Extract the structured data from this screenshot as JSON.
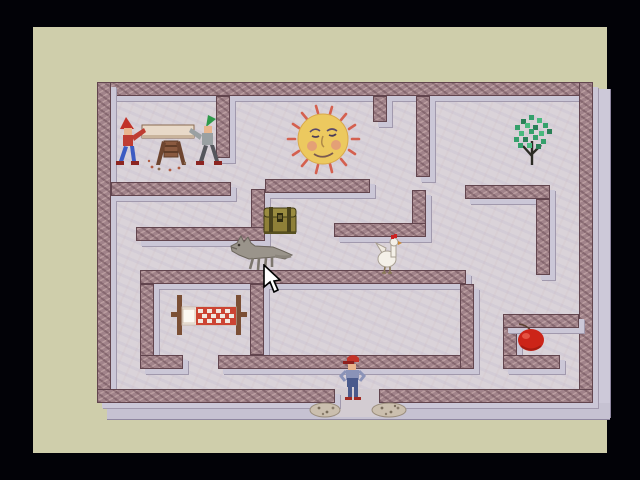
{
  "game": {
    "scene": "isometric stone maze on tan game screen with black surround",
    "entrance": "gap in bottom wall at center with rubble piles on both sides"
  },
  "colors": {
    "surround": "#020207",
    "screen": "#cfceab",
    "floor": "#dad3d9",
    "wall_top": "#a1838a",
    "wall_edge": "#62454e",
    "wall_side": "#cbc7d7",
    "sun_body": "#ecc95f",
    "sun_rays": "#d4604f",
    "tree_leaf": "#35a06b",
    "apple": "#cc2418",
    "bed_blanket": "#cc4433",
    "gnome_cap_left": "#c13228",
    "gnome_cap_right": "#2f9a4a",
    "boy_overalls": "#4a5a8c"
  },
  "maze": {
    "floor_rect": "left:64px;top:55px;width:496px;height:321px;background-color:#dad3d9;background-image:repeating-linear-gradient(23deg, rgba(170,160,195,.14) 0 3px, rgba(0,0,0,0) 3px 9px),repeating-linear-gradient(-67deg, rgba(200,170,170,.10) 0 2px, rgba(0,0,0,0) 2px 11px);",
    "ext_right": "left:560px;top:62px;width:17px;height:328px;background:#cdc9d9;border-right:1px solid #8f87a0;border-bottom:1px solid #8f87a0;",
    "ext_bottom": "left:74px;top:376px;width:503px;height:16px;background:#c6c2d2;border-bottom:1px solid #8f87a0;",
    "entrance_rect": "left:302px;top:362px;width:44px;height:28px;background:#d3ccd2;",
    "walls": [
      {
        "name": "outer-top",
        "x": 64,
        "y": 55,
        "w": 496,
        "h": 14
      },
      {
        "name": "outer-left",
        "x": 64,
        "y": 55,
        "w": 14,
        "h": 321
      },
      {
        "name": "outer-right",
        "x": 546,
        "y": 55,
        "w": 14,
        "h": 321
      },
      {
        "name": "outer-bottom-left",
        "x": 64,
        "y": 362,
        "w": 238,
        "h": 14
      },
      {
        "name": "outer-bottom-right",
        "x": 346,
        "y": 362,
        "w": 214,
        "h": 14
      },
      {
        "name": "gnome-room-right",
        "x": 183,
        "y": 69,
        "w": 14,
        "h": 62
      },
      {
        "name": "gnome-room-bottom",
        "x": 78,
        "y": 155,
        "w": 120,
        "h": 14
      },
      {
        "name": "chest-left-vertical",
        "x": 218,
        "y": 162,
        "w": 14,
        "h": 52
      },
      {
        "name": "mid-left-horizontal",
        "x": 103,
        "y": 200,
        "w": 129,
        "h": 14
      },
      {
        "name": "sun-room-bottom",
        "x": 232,
        "y": 152,
        "w": 105,
        "h": 14
      },
      {
        "name": "top-stub",
        "x": 340,
        "y": 69,
        "w": 14,
        "h": 26
      },
      {
        "name": "center-top-vertical",
        "x": 383,
        "y": 69,
        "w": 14,
        "h": 81
      },
      {
        "name": "chicken-right-vertical",
        "x": 379,
        "y": 163,
        "w": 14,
        "h": 47
      },
      {
        "name": "chicken-top",
        "x": 301,
        "y": 196,
        "w": 92,
        "h": 14
      },
      {
        "name": "center-long",
        "x": 107,
        "y": 243,
        "w": 326,
        "h": 14
      },
      {
        "name": "bed-room-left",
        "x": 107,
        "y": 257,
        "w": 14,
        "h": 85
      },
      {
        "name": "bed-room-right",
        "x": 217,
        "y": 257,
        "w": 14,
        "h": 71
      },
      {
        "name": "bed-room-bottom",
        "x": 107,
        "y": 328,
        "w": 43,
        "h": 14
      },
      {
        "name": "boy-corridor-top",
        "x": 185,
        "y": 328,
        "w": 256,
        "h": 14
      },
      {
        "name": "center-low-vertical",
        "x": 427,
        "y": 257,
        "w": 14,
        "h": 85
      },
      {
        "name": "apple-left-vertical",
        "x": 470,
        "y": 287,
        "w": 14,
        "h": 53
      },
      {
        "name": "apple-top",
        "x": 470,
        "y": 287,
        "w": 76,
        "h": 14
      },
      {
        "name": "apple-bottom",
        "x": 470,
        "y": 328,
        "w": 57,
        "h": 14
      },
      {
        "name": "tree-room-bottom",
        "x": 432,
        "y": 158,
        "w": 85,
        "h": 14
      },
      {
        "name": "tree-room-right",
        "x": 503,
        "y": 172,
        "w": 14,
        "h": 76
      }
    ]
  },
  "objects": {
    "gnomes": {
      "label": "two gnomes sawing a log on a trestle",
      "style": "left:79px;top:84px;width:114px;height:64px"
    },
    "sun": {
      "label": "smiling sun with rays",
      "style": "left:251px;top:72px;width:78px;height:78px"
    },
    "tree": {
      "label": "green tree",
      "style": "left:476px;top:86px;width:46px;height:54px"
    },
    "chest": {
      "label": "treasure chest",
      "style": "left:229px;top:176px;width:36px;height:33px"
    },
    "wolf": {
      "label": "gray wolf",
      "style": "left:196px;top:206px;width:64px;height:40px"
    },
    "chicken": {
      "label": "white chicken",
      "style": "left:341px;top:206px;width:28px;height:42px"
    },
    "bed": {
      "label": "bed with red checkered blanket",
      "style": "left:136px;top:266px;width:80px;height:44px"
    },
    "apple": {
      "label": "red apple",
      "style": "left:482px;top:296px;width:32px;height:29px"
    },
    "boy": {
      "label": "boy in red cap and blue overalls at maze entrance",
      "style": "left:306px;top:327px;width:28px;height:48px"
    },
    "rubble_left": {
      "label": "rubble pile left of entrance",
      "style": "left:276px;top:372px;width:32px;height:19px"
    },
    "rubble_right": {
      "label": "rubble pile right of entrance",
      "style": "left:338px;top:371px;width:36px;height:20px"
    },
    "cursor": {
      "label": "mouse arrow pointer",
      "style": "left:229px;top:237px;width:20px;height:29px"
    }
  }
}
